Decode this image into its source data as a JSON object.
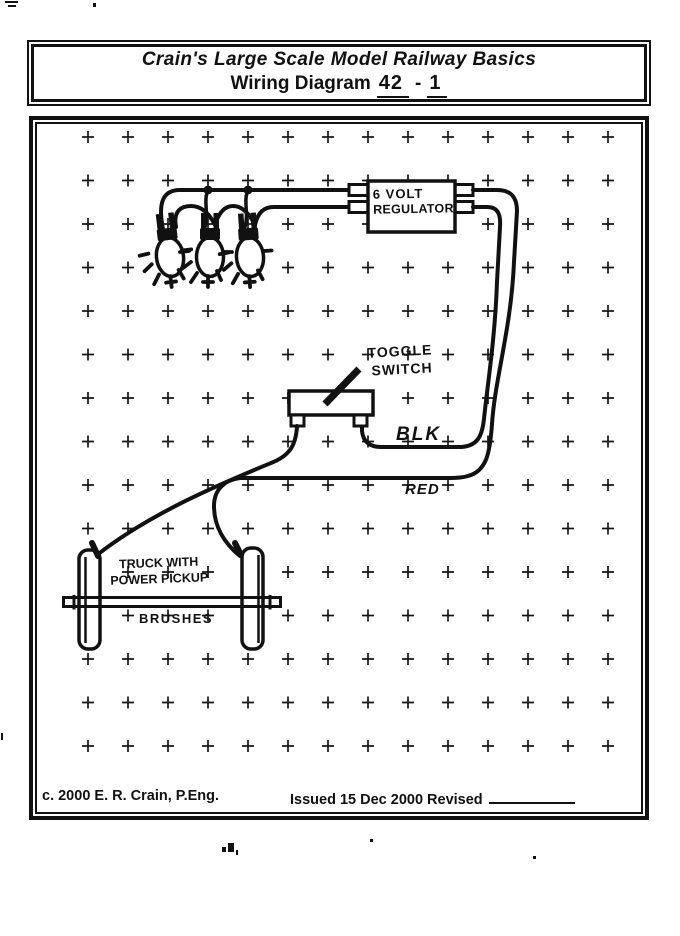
{
  "title_box": {
    "line1": "Crain's Large Scale Model Railway Basics",
    "line2_prefix": "Wiring Diagram",
    "number_main": "42",
    "separator": "-",
    "number_rev": "1"
  },
  "diagram": {
    "labels": {
      "regulator_line1": "6 VOLT",
      "regulator_line2": "REGULATOR",
      "toggle_line1": "TOGGLE",
      "toggle_line2": "SWITCH",
      "wire_black": "BLK",
      "wire_red": "RED",
      "truck_line1": "TRUCK WITH",
      "truck_line2": "POWER PICKUP",
      "truck_line3": "BRUSHES"
    },
    "components": {
      "lamps_count": 3,
      "regulator": "6 volt regulator with two input and two output terminals",
      "switch": "toggle switch",
      "pickup": "truck with power pickup brushes"
    }
  },
  "footer": {
    "copyright": "c. 2000 E. R. Crain, P.Eng.",
    "issued": "Issued 15 Dec 2000 Revised"
  },
  "colors": {
    "ink": "#111111",
    "paper": "#ffffff"
  }
}
